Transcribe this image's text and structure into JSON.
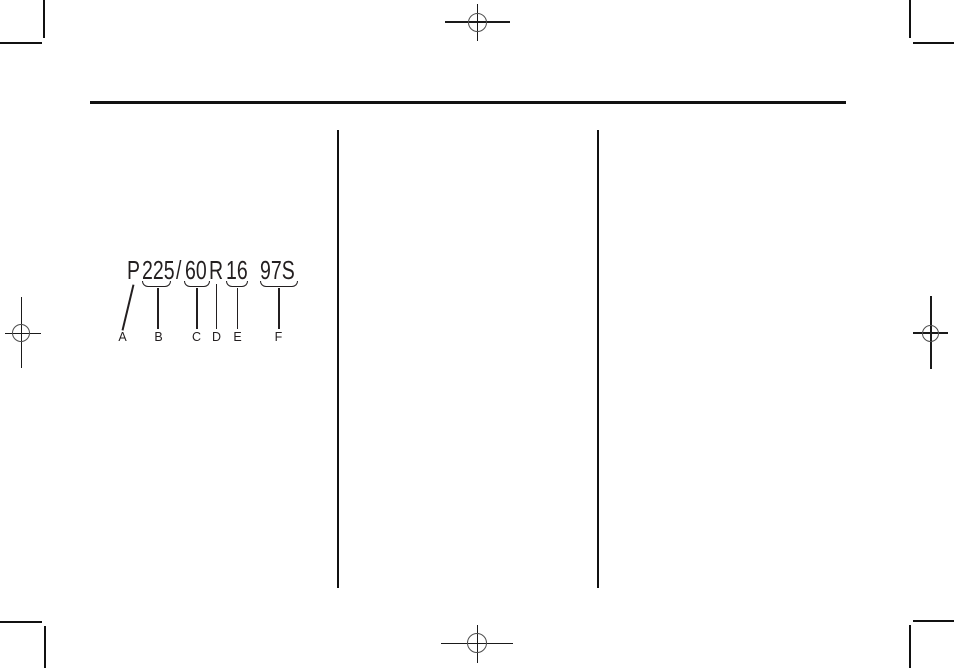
{
  "page": {
    "background_color": "#ffffff",
    "ink_color": "#231f20"
  },
  "tire_code_diagram": {
    "full_code": "P225/60R16 97S",
    "segments": [
      {
        "text": "P"
      },
      {
        "text": "225"
      },
      {
        "text": "/"
      },
      {
        "text": "60"
      },
      {
        "text": "R"
      },
      {
        "text": "16"
      },
      {
        "text": "97S"
      }
    ],
    "callouts": [
      {
        "letter": "A"
      },
      {
        "letter": "B"
      },
      {
        "letter": "C"
      },
      {
        "letter": "D"
      },
      {
        "letter": "E"
      },
      {
        "letter": "F"
      }
    ]
  }
}
